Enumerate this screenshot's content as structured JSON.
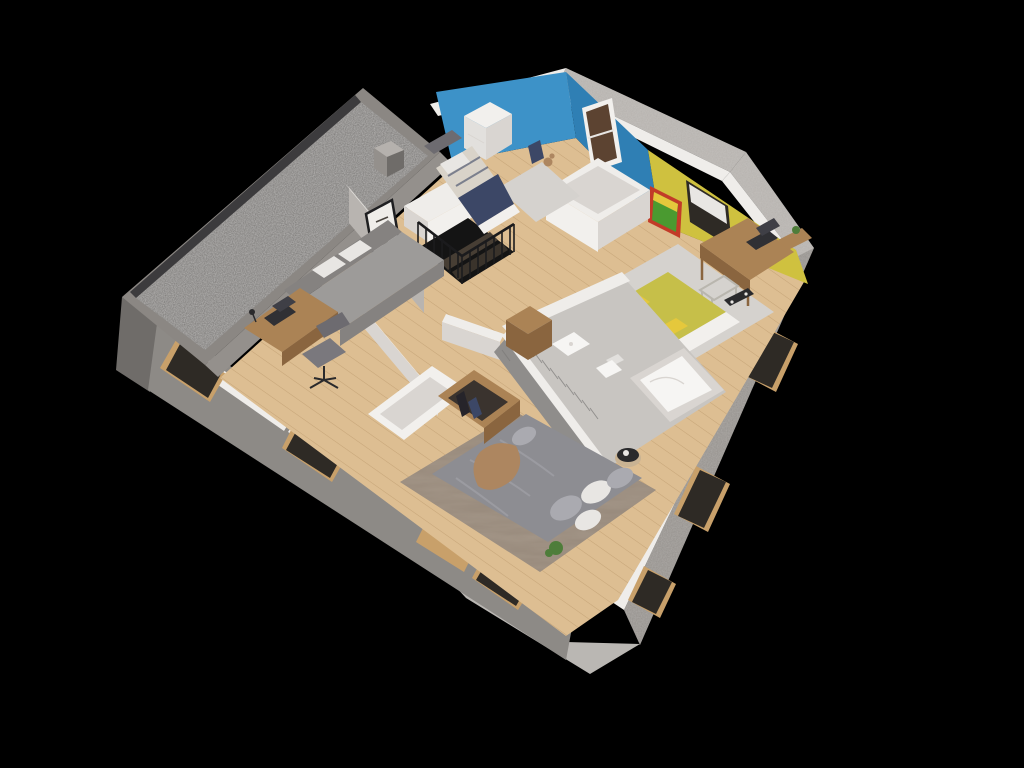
{
  "scene": {
    "kind": "3d-floorplan-cutaway-render",
    "view": "isometric-dollhouse",
    "level": "upper-floor",
    "rooms": [
      {
        "name": "kids-bedroom-blue",
        "wall_color": "#3d92c8",
        "items": [
          "single-bed",
          "navy-blanket",
          "white-dresser",
          "gray-rug",
          "backpack",
          "teddy-bear",
          "brown-door"
        ]
      },
      {
        "name": "teen-bedroom-yellow",
        "wall_color": "#cfc13f",
        "items": [
          "comic-poster",
          "window-with-blind",
          "wooden-desk",
          "laptop",
          "cantilever-chair",
          "wall-shelf",
          "plant",
          "yellow-bed",
          "patterned-pillows",
          "skateboard",
          "light-rug"
        ]
      },
      {
        "name": "office-guest-room",
        "items": [
          "gray-daybed",
          "white-pillows",
          "wooden-desk",
          "laptop",
          "desk-lamp",
          "office-chair",
          "eagle-picture-frame"
        ]
      },
      {
        "name": "hallway-landing",
        "items": [
          "winder-staircase",
          "black-metal-railing",
          "white-storage-unit",
          "half-wall"
        ]
      },
      {
        "name": "bathroom",
        "items": [
          "bathtub",
          "wall-hung-sink",
          "toilet",
          "wooden-cabinet",
          "dark-slat-wall",
          "stone-floor"
        ]
      },
      {
        "name": "master-bedroom",
        "items": [
          "platform-bed",
          "gray-duvet",
          "tan-throw",
          "pillows",
          "large-area-rug",
          "white-wardrobe",
          "open-wood-closet",
          "hanging-clothes",
          "plant",
          "round-side-table",
          "coffee-cup"
        ]
      },
      {
        "name": "flat-roof",
        "items": [
          "gravel-surface",
          "roof-frame",
          "chimney"
        ]
      }
    ]
  },
  "palette": {
    "bg": "#000000",
    "cutTop": "#efedea",
    "cutTopShade": "#d9d5d1",
    "concreteLight": "#b5b1ad",
    "concreteMid": "#94908c",
    "concreteSW": "#8d8a86",
    "concreteDark": "#6f6c69",
    "roofFrame": "#8b8783",
    "gravel": "#767472",
    "roofStrip": "#3c3b3d",
    "slabCut": "#bab7b3",
    "woodFloor": "#ddbe92",
    "plankLine": "rgba(140,100,55,0.28)",
    "woodTrim": "#c8a06a",
    "woodFurn": "#ab8355",
    "woodFurnDark": "#8a653f",
    "wallWhite": "#f2f0ed",
    "wallWhiteShade": "#d9d5d1",
    "wallGray": "#b8b4b0",
    "wallBlue": "#3d92c8",
    "wallBlueDark": "#2f7fb4",
    "wallYellow": "#cfc13f",
    "bedYellow": "#c6bf49",
    "bathFloor": "#c8c5c1",
    "bathWallDark": "#8f8d8b",
    "slatLine": "#7b7977",
    "tubWhite": "#f6f5f3",
    "fixtureShade": "#e2e0dd",
    "stairBlack": "#1b1b1d",
    "stairHole": "#141414",
    "stepWood": "#473e34",
    "stepWood2": "#3a332b",
    "rugLight": "#d5d2ce",
    "rugMaster": "#96887a",
    "bedGray": "#8d8d92",
    "bedGrayLight": "#aaaab0",
    "pillowWhite": "#e8e6e3",
    "throwTan": "#ad8660",
    "bedNavy": "#3c4766",
    "bedStripe": "#d9d3c9",
    "sofaGray": "#9d9b99",
    "sofaGrayDark": "#858280",
    "chairGray": "#7a787d",
    "chairGrayDark": "#6d6b70",
    "laptopDark": "#303034",
    "laptopScreen": "#3f3f46",
    "plantGreen": "#4e7d3a",
    "plantPot": "#8a6f52",
    "posterRed": "#c23b28",
    "posterGreen": "#4a9a30",
    "posterYellow": "#e5c83c",
    "metal": "#b9b6ae",
    "tableDark": "#2a2a2c",
    "basket": "#c9b393",
    "doorBrown": "#5c4331",
    "windowDark": "#2e2a25",
    "frameBlack": "#1f1f21",
    "glyphDark": "#4a453f",
    "shadow": "rgba(0,0,0,0.16)"
  }
}
